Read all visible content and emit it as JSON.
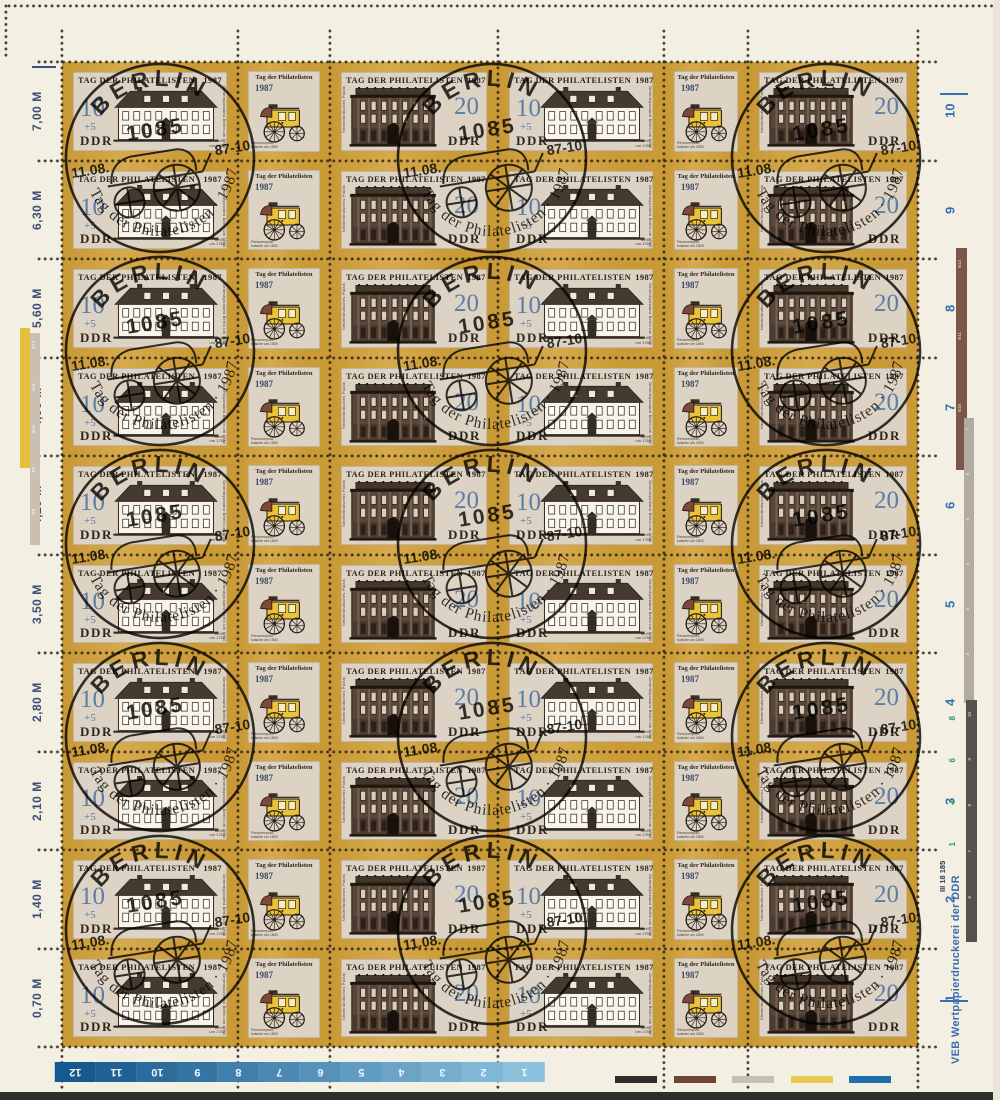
{
  "sheet": {
    "row_count": 10,
    "column_pattern": [
      "stamp_10",
      "coach_label",
      "stamp_20",
      "stamp_10",
      "coach_label",
      "stamp_20"
    ],
    "colors": {
      "paper": "#f3efe3",
      "frame_gold": "#d1a039",
      "stamp_background": "#dcd3c5",
      "value_blue": "#5b7da6",
      "ink_dark": "#30261b",
      "postmark_ink": "#17130d",
      "margin_value_color": "#3d4e74",
      "margin_number_blue": "#3a6fb0"
    }
  },
  "stamps": {
    "stamp_10": {
      "title": "TAG DER PHILATELISTEN",
      "year": "1987",
      "value": "10",
      "surcharge": "+5",
      "country": "DDR",
      "caption_line1": "Berlin",
      "caption_line2": "um 1780",
      "side_text": "Generalpostamt Berlin um 1780"
    },
    "stamp_20": {
      "title": "TAG DER PHILATELISTEN",
      "year": "1987",
      "value": "20",
      "country": "DDR",
      "side_text": "Niederländisches Palais"
    },
    "coach_label": {
      "title": "Tag der Philatelisten",
      "year": "1987",
      "caption_line1": "Personenpost-",
      "caption_line2": "kutsche um 1800"
    }
  },
  "postmark": {
    "city": "BERLIN",
    "postal_code": "1085",
    "date_left": "11.08.",
    "date_right": "87-10",
    "arc_text": "Tag der Philatelisten · 1987"
  },
  "left_margin": {
    "row_values": [
      "7,00 M",
      "6,30 M",
      "5,60 M",
      "4,90 M",
      "4,20 M",
      "3,50 M",
      "2,80 M",
      "2,10 M",
      "1,40 M",
      "0,70 M"
    ],
    "strip_labels": [
      "B12",
      "B11",
      "B10",
      "B9",
      "B8"
    ],
    "yellow_strip_color": "#e2bf3e",
    "beige_strip_color": "#cac0b0"
  },
  "right_margin": {
    "row_numbers": [
      "10",
      "9",
      "8",
      "7",
      "6",
      "5",
      "4",
      "3",
      "2",
      "1"
    ],
    "brown_strip_labels": [
      "B12",
      "B11",
      "B10"
    ],
    "grey_strip_labels": [
      "7",
      "6",
      "5",
      "4",
      "3",
      "2"
    ],
    "dark_strip_labels": [
      "10",
      "9",
      "8",
      "7",
      "6"
    ],
    "green_digits": [
      "8",
      "6",
      "4",
      "1"
    ],
    "imprint_code": "III 18 185",
    "printer": "VEB Wertpapierdruckerei der DDR",
    "brown_strip_color": "#7b574a",
    "grey_strip_color": "#b3aaa0",
    "dark_strip_color": "#55534e"
  },
  "bottom_margin": {
    "counter_labels": [
      "12",
      "11",
      "10",
      "9",
      "8",
      "7",
      "6",
      "5",
      "4",
      "3",
      "2",
      "1"
    ],
    "bar_color_dark": "#15598f",
    "bar_color_light": "#8cc0dd",
    "swatch_colors": [
      "#2d2d2b",
      "#6f4338",
      "#c6bfb5",
      "#e9c94b",
      "#1f6fad"
    ]
  }
}
